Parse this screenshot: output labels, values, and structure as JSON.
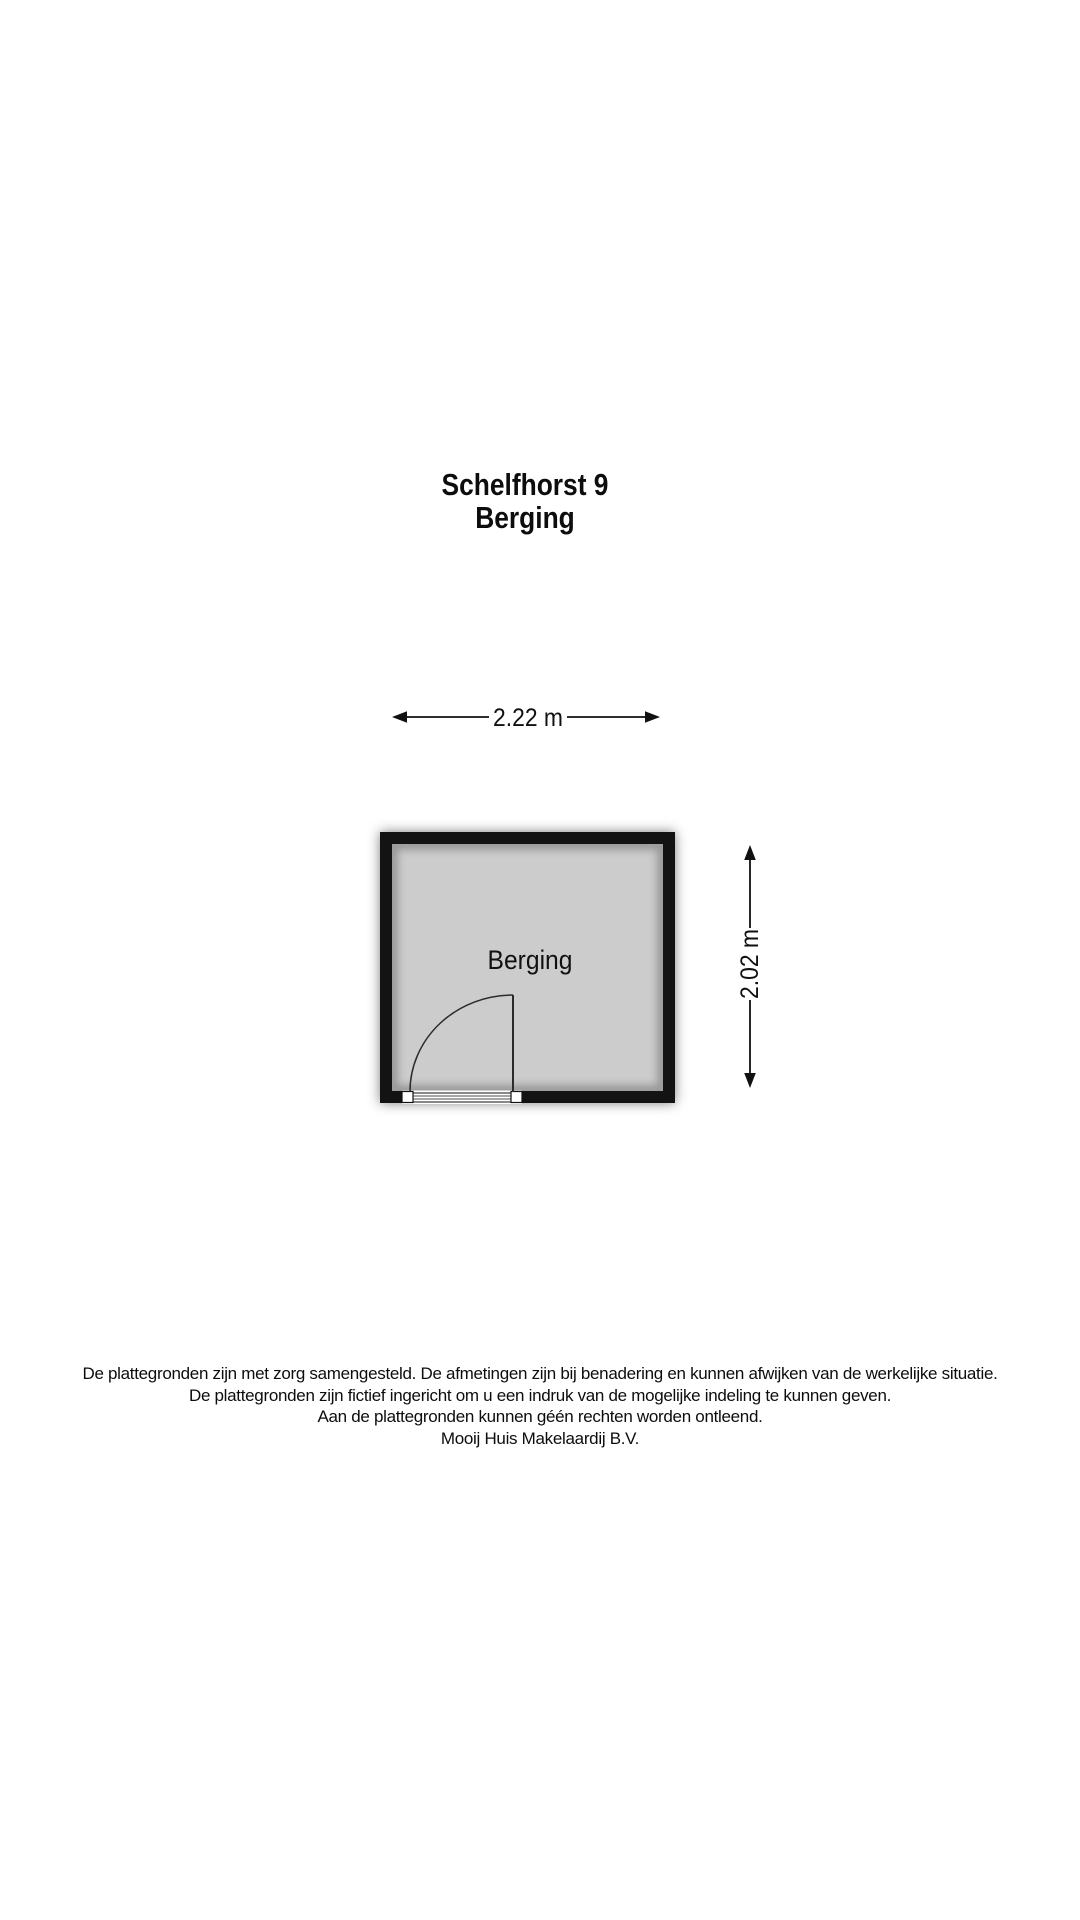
{
  "title": {
    "line1": "Schelfhorst 9",
    "line2": "Berging"
  },
  "floorplan": {
    "room_label": "Berging",
    "width_dimension": "2.22 m",
    "height_dimension": "2.02 m",
    "colors": {
      "wall": "#131313",
      "floor": "#cccccc",
      "line": "#2b2b2b",
      "background": "#ffffff"
    }
  },
  "disclaimer": {
    "lines": [
      "De plattegronden zijn met zorg samengesteld. De afmetingen zijn bij benadering en kunnen afwijken van de werkelijke situatie.",
      "De plattegronden zijn fictief ingericht om u een indruk van de mogelijke indeling te kunnen geven.",
      "Aan de plattegronden kunnen géén rechten worden ontleend.",
      "Mooij Huis Makelaardij B.V."
    ]
  }
}
